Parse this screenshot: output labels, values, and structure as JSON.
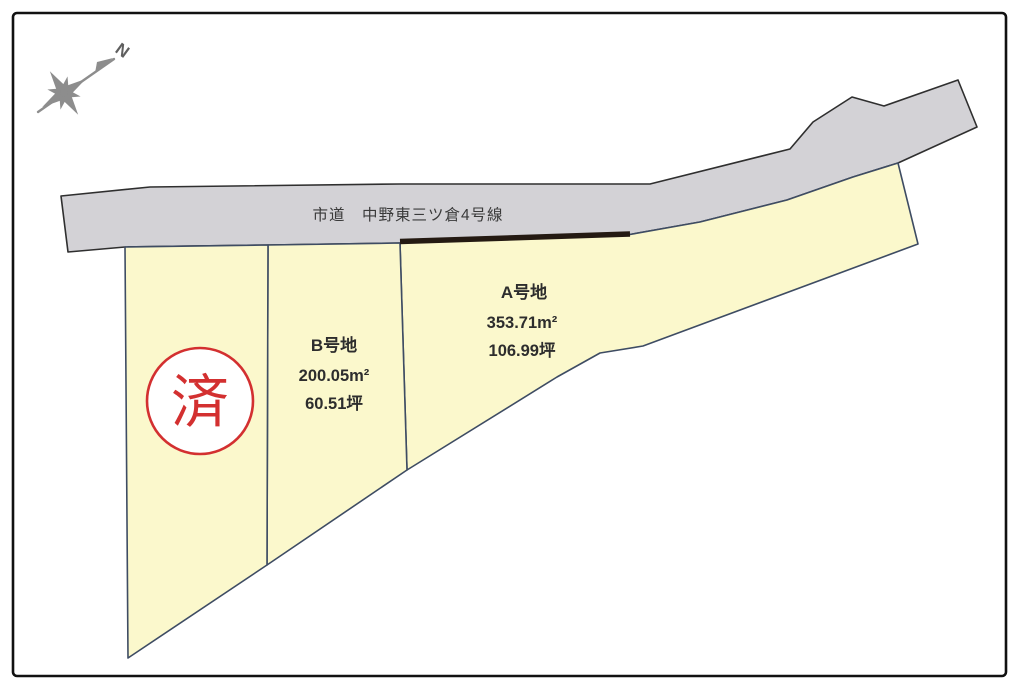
{
  "title": "宅地区画図",
  "compass": {
    "north_label": "N"
  },
  "road": {
    "label": "市道　中野東三ツ倉4号線"
  },
  "parcels": {
    "a": {
      "name": "A号地",
      "area_sqm": "353.71m²",
      "area_tsubo": "106.99坪"
    },
    "b": {
      "name": "B号地",
      "area_sqm": "200.05m²",
      "area_tsubo": "60.51坪"
    },
    "left": {
      "stamp": "済"
    }
  },
  "colors": {
    "parcel_fill": "#fbf8cc",
    "road_fill": "#d3d2d6",
    "parcel_stroke": "#3e4c63",
    "road_stroke": "#2f2f2f",
    "frontage_line": "#241a12",
    "stamp_red": "#d33030",
    "label_text": "#2d2d2d",
    "compass_gray": "#8d8d8d",
    "frame": "#111111"
  }
}
